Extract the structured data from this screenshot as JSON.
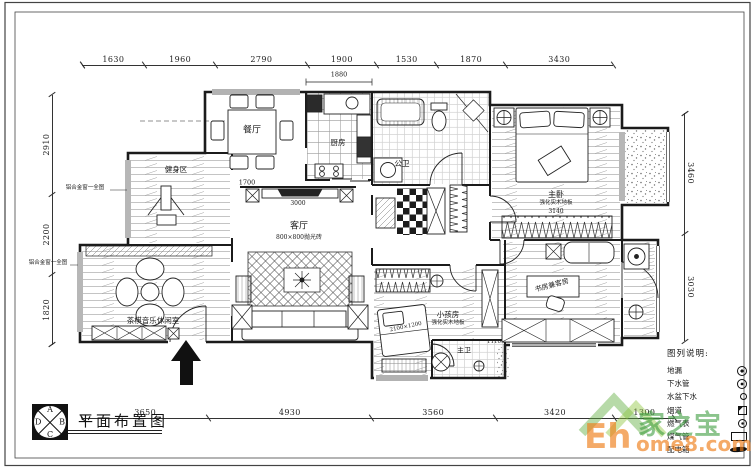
{
  "title_block": {
    "title": "平面布置图",
    "compass": [
      "A",
      "B",
      "C",
      "D"
    ]
  },
  "dims": {
    "top": [
      "1630",
      "1960",
      "2790",
      "1900",
      "1530",
      "1870",
      "3430"
    ],
    "bottom": [
      "3650",
      "4930",
      "3560",
      "3420",
      "1300"
    ],
    "left": [
      "1820",
      "2200",
      "2910"
    ],
    "right": [
      "3460",
      "3030"
    ]
  },
  "rooms": {
    "dining": {
      "label": "餐厅"
    },
    "kitchen": {
      "label": "厨房"
    },
    "fitness": {
      "label": "健身区"
    },
    "leisure": {
      "label": "茶棋音乐休闲室"
    },
    "living": {
      "label": "客厅",
      "floor": "800×800抛光砖"
    },
    "guest_bath": {
      "label": "公卫"
    },
    "master_bed": {
      "label": "主卧",
      "floor": "强化实木地板",
      "dim": "3140"
    },
    "kids": {
      "label": "小孩房",
      "floor": "强化实木地板"
    },
    "study": {
      "label": "书房兼客房"
    },
    "master_bath": {
      "label": "主卫"
    }
  },
  "inner_dims": {
    "dining_living": "1700",
    "kitchen_top": "1880",
    "tv_wall": "3000",
    "kids_bed": "2100×1200",
    "bath_door": "1110"
  },
  "notes": {
    "window_note_1": "铝合金窗一全图",
    "window_note_2": "铝合金窗一全图"
  },
  "legend": {
    "title": "图列说明:",
    "items": [
      {
        "label": "地漏",
        "icon": "floor-drain"
      },
      {
        "label": "下水管",
        "icon": "drain-pipe"
      },
      {
        "label": "水盆下水",
        "icon": "basin-drain"
      },
      {
        "label": "烟道",
        "icon": "flue"
      },
      {
        "label": "燃气表",
        "icon": "gas-meter"
      },
      {
        "label": "煤气管",
        "icon": "gas-pipe"
      },
      {
        "label": "配电箱",
        "icon": "power-box"
      }
    ]
  },
  "watermark": {
    "brand": "家之宝",
    "site_bold": "Eh",
    "site_rest": "ome8.com",
    "green": "#3f9e40",
    "orange": "#ef7d18"
  }
}
